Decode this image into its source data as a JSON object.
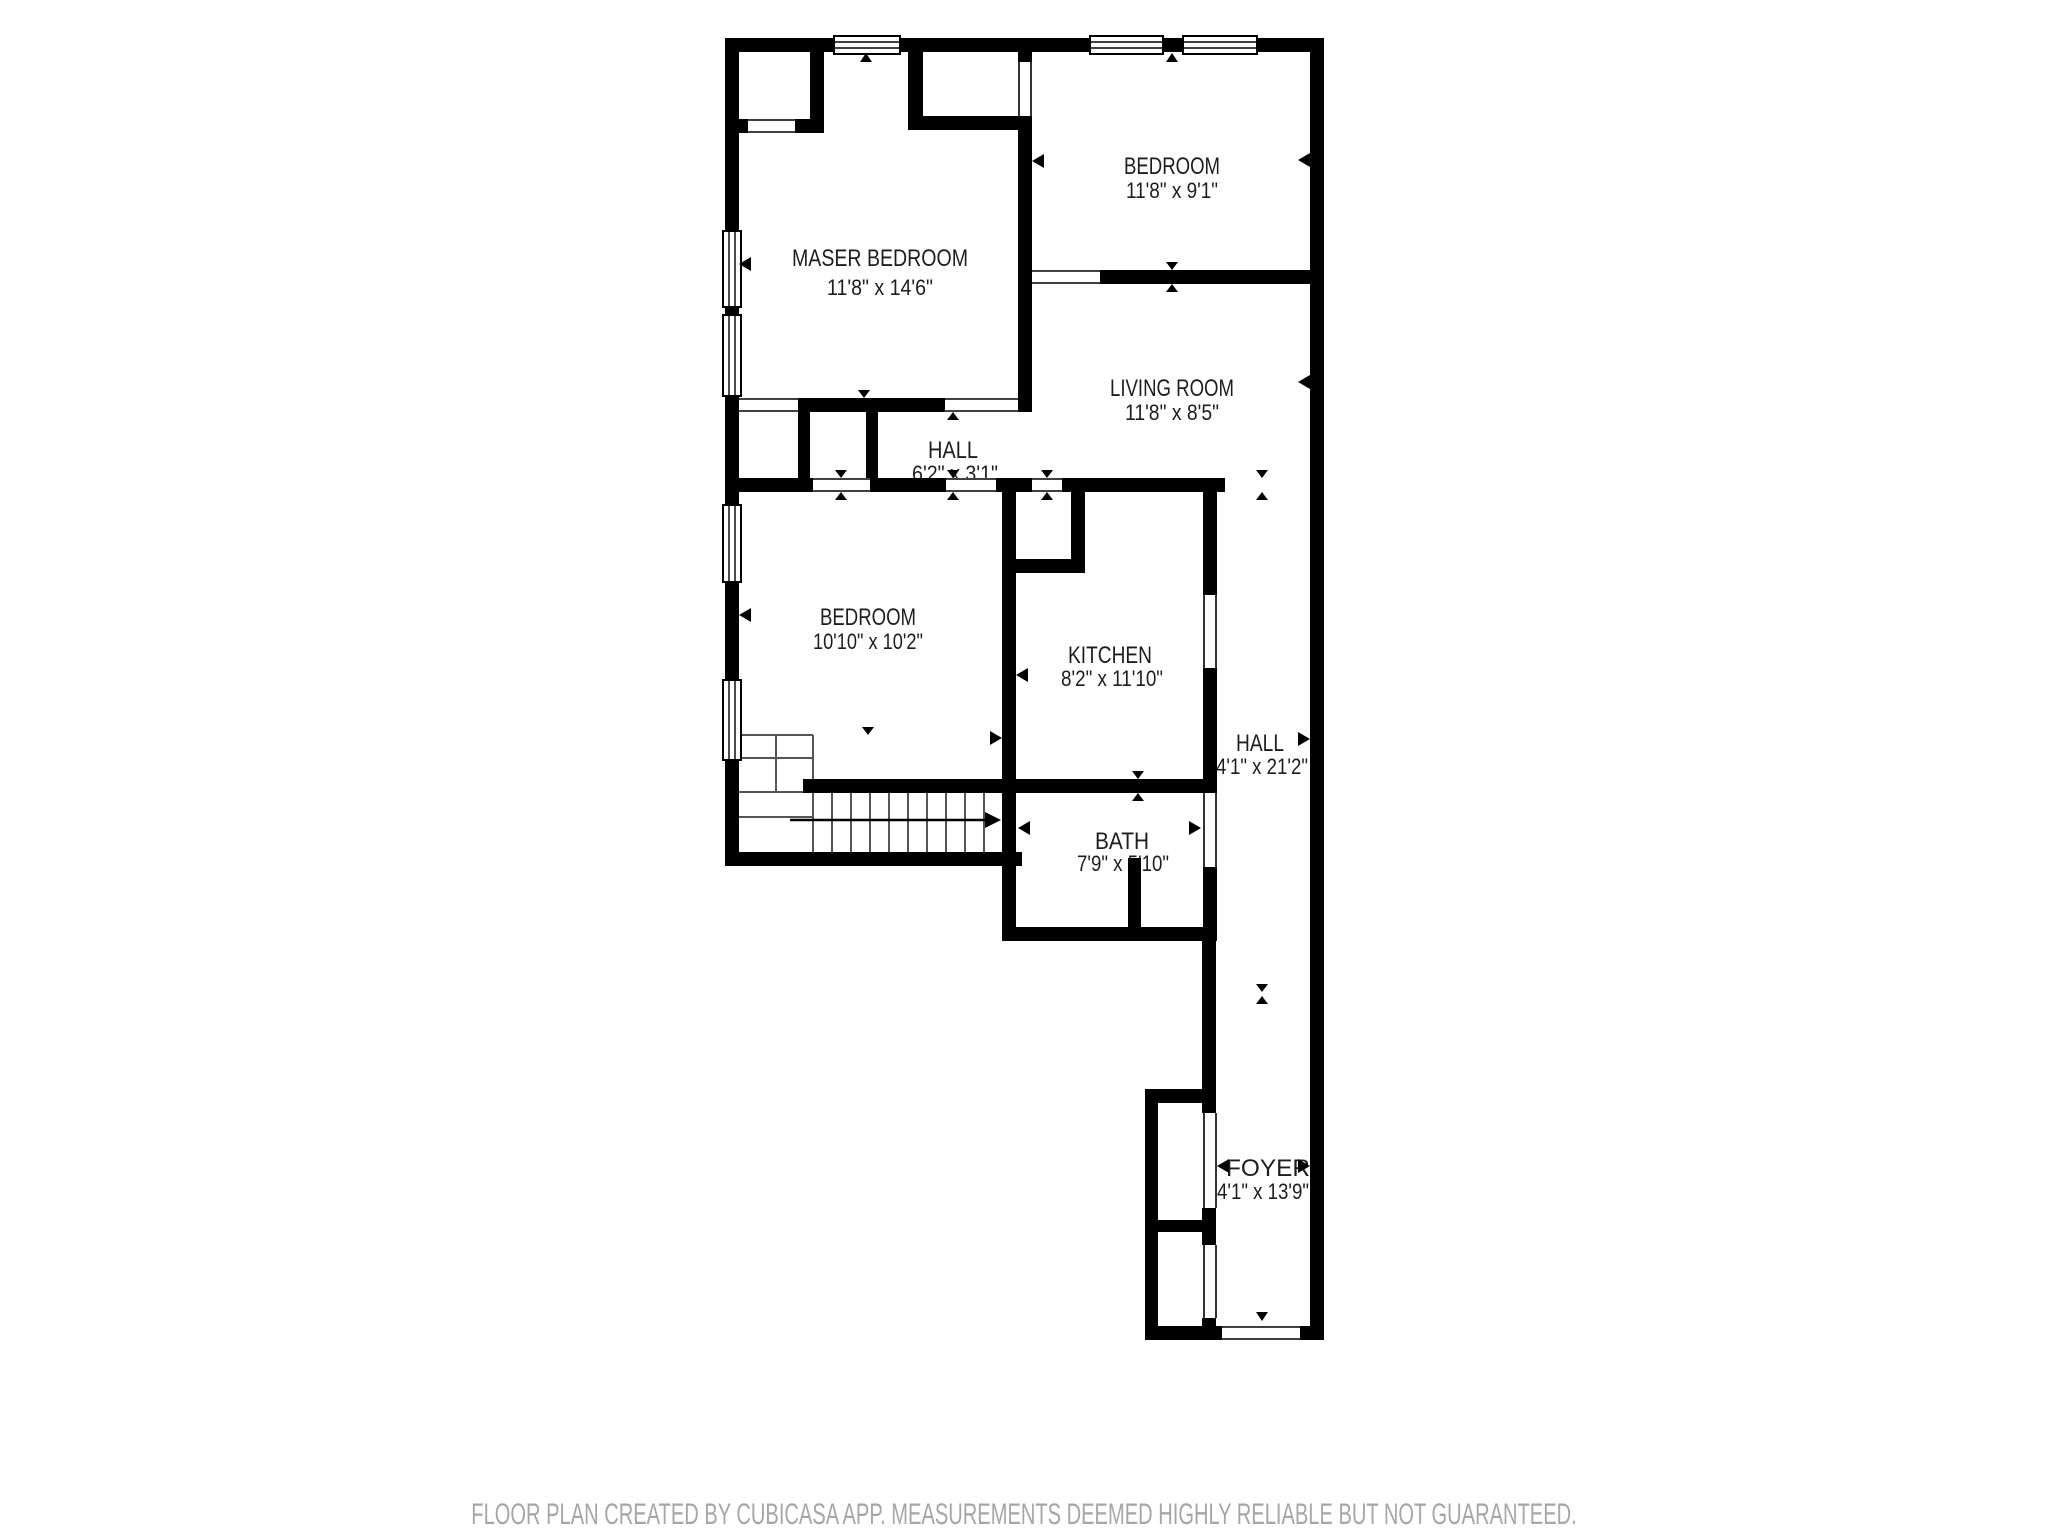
{
  "footer": {
    "disclaimer": "FLOOR PLAN CREATED BY CUBICASA APP. MEASUREMENTS DEEMED HIGHLY RELIABLE BUT NOT GUARANTEED."
  },
  "colors": {
    "wall": "#000000",
    "background": "#ffffff",
    "label": "#1d1d1d",
    "stair_line": "#555555",
    "footer_text": "#a6a6a6"
  },
  "rooms": [
    {
      "id": "master-bedroom",
      "name": "MASER BEDROOM",
      "dimensions": "11'8\" x 14'6\"",
      "label": {
        "x": 880,
        "y": 266,
        "w": 176
      },
      "dim": {
        "x": 880,
        "y": 295,
        "w": 106
      }
    },
    {
      "id": "bedroom-top",
      "name": "BEDROOM",
      "dimensions": "11'8\" x 9'1\"",
      "label": {
        "x": 1172,
        "y": 174,
        "w": 96
      },
      "dim": {
        "x": 1172,
        "y": 198,
        "w": 92
      }
    },
    {
      "id": "living-room",
      "name": "LIVING ROOM",
      "dimensions": "11'8\" x 8'5\"",
      "label": {
        "x": 1172,
        "y": 396,
        "w": 124
      },
      "dim": {
        "x": 1172,
        "y": 420,
        "w": 94
      }
    },
    {
      "id": "hall",
      "name": "HALL",
      "dimensions": "6'2\" x 3'1\"",
      "label": {
        "x": 953,
        "y": 458,
        "w": 50
      },
      "dim": {
        "x": 955,
        "y": 481,
        "w": 86
      }
    },
    {
      "id": "bedroom-left",
      "name": "BEDROOM",
      "dimensions": "10'10\" x 10'2\"",
      "label": {
        "x": 868,
        "y": 625,
        "w": 96
      },
      "dim": {
        "x": 868,
        "y": 649,
        "w": 110
      }
    },
    {
      "id": "kitchen",
      "name": "KITCHEN",
      "dimensions": "8'2\" x 11'10\"",
      "label": {
        "x": 1110,
        "y": 663,
        "w": 84
      },
      "dim": {
        "x": 1112,
        "y": 686,
        "w": 102
      }
    },
    {
      "id": "hall-corridor",
      "name": "HALL",
      "dimensions": "4'1\" x 21'2\"",
      "label": {
        "x": 1260,
        "y": 751,
        "w": 48
      },
      "dim": {
        "x": 1262,
        "y": 774,
        "w": 92
      }
    },
    {
      "id": "bath",
      "name": "BATH",
      "dimensions": "7'9\" x 5'10\"",
      "label": {
        "x": 1122,
        "y": 849,
        "w": 54
      },
      "dim": {
        "x": 1123,
        "y": 871,
        "w": 92
      }
    },
    {
      "id": "foyer",
      "name": "FOYER",
      "dimensions": "4'1\" x 13'9\"",
      "label": {
        "x": 1268,
        "y": 1176,
        "w": 84
      },
      "dim": {
        "x": 1263,
        "y": 1199,
        "w": 92
      }
    }
  ],
  "geometry": {
    "walls": [
      [
        725,
        38,
        109,
        14
      ],
      [
        900,
        38,
        190,
        14
      ],
      [
        1163,
        38,
        20,
        14
      ],
      [
        1257,
        38,
        67,
        14
      ],
      [
        1310,
        38,
        14,
        1302
      ],
      [
        725,
        38,
        14,
        193
      ],
      [
        725,
        307,
        14,
        8
      ],
      [
        725,
        396,
        14,
        109
      ],
      [
        725,
        582,
        14,
        98
      ],
      [
        725,
        760,
        14,
        106
      ],
      [
        725,
        852,
        297,
        14
      ],
      [
        1002,
        482,
        14,
        459
      ],
      [
        1002,
        927,
        214,
        14
      ],
      [
        1202,
        941,
        14,
        162
      ],
      [
        1145,
        1089,
        71,
        14
      ],
      [
        1145,
        1089,
        13,
        251
      ],
      [
        1145,
        1326,
        77,
        14
      ],
      [
        1300,
        1326,
        24,
        14
      ],
      [
        810,
        38,
        14,
        95
      ],
      [
        739,
        119,
        9,
        14
      ],
      [
        795,
        119,
        29,
        14
      ],
      [
        908,
        38,
        15,
        92
      ],
      [
        908,
        116,
        124,
        14
      ],
      [
        1018,
        52,
        14,
        10
      ],
      [
        1018,
        116,
        14,
        296
      ],
      [
        798,
        398,
        147,
        14
      ],
      [
        798,
        412,
        12,
        66
      ],
      [
        866,
        412,
        12,
        66
      ],
      [
        725,
        478,
        88,
        14
      ],
      [
        870,
        478,
        76,
        14
      ],
      [
        996,
        478,
        36,
        14
      ],
      [
        1062,
        478,
        163,
        14
      ],
      [
        1071,
        492,
        14,
        81
      ],
      [
        1016,
        559,
        69,
        14
      ],
      [
        1100,
        270,
        224,
        14
      ],
      [
        803,
        779,
        413,
        14
      ],
      [
        1203,
        492,
        14,
        103
      ],
      [
        1203,
        668,
        14,
        125
      ],
      [
        1203,
        867,
        14,
        74
      ],
      [
        1202,
        1103,
        14,
        10
      ],
      [
        1202,
        1208,
        14,
        37
      ],
      [
        1202,
        1318,
        14,
        8
      ],
      [
        1158,
        1220,
        58,
        12
      ],
      [
        1128,
        858,
        13,
        69
      ]
    ],
    "windows": [
      [
        834,
        36,
        66,
        18
      ],
      [
        1090,
        36,
        73,
        18
      ],
      [
        1183,
        36,
        74,
        18
      ],
      [
        723,
        231,
        18,
        76
      ],
      [
        723,
        315,
        18,
        81
      ],
      [
        723,
        505,
        18,
        77
      ],
      [
        723,
        680,
        18,
        80
      ]
    ],
    "doors": [
      [
        748,
        119,
        47,
        14,
        "h"
      ],
      [
        1018,
        62,
        14,
        54,
        "v"
      ],
      [
        945,
        398,
        73,
        14,
        "h"
      ],
      [
        739,
        398,
        59,
        14,
        "h"
      ],
      [
        813,
        478,
        57,
        14,
        "h"
      ],
      [
        946,
        478,
        50,
        14,
        "h"
      ],
      [
        1032,
        478,
        30,
        14,
        "h"
      ],
      [
        1032,
        270,
        68,
        14,
        "h"
      ],
      [
        1203,
        595,
        14,
        73,
        "v"
      ],
      [
        1203,
        793,
        14,
        74,
        "v"
      ],
      [
        1203,
        1113,
        14,
        95,
        "v"
      ],
      [
        1203,
        1245,
        14,
        73,
        "v"
      ],
      [
        1222,
        1326,
        78,
        14,
        "h"
      ]
    ],
    "stairs": {
      "lines": [
        [
          832,
          793,
          832,
          852
        ],
        [
          851,
          793,
          851,
          852
        ],
        [
          870,
          793,
          870,
          852
        ],
        [
          889,
          793,
          889,
          852
        ],
        [
          908,
          793,
          908,
          852
        ],
        [
          927,
          793,
          927,
          852
        ],
        [
          946,
          793,
          946,
          852
        ],
        [
          965,
          793,
          965,
          852
        ],
        [
          984,
          793,
          984,
          852
        ],
        [
          739,
          735,
          813,
          735
        ],
        [
          739,
          758,
          813,
          758
        ],
        [
          739,
          792,
          813,
          792
        ],
        [
          739,
          817,
          813,
          817
        ],
        [
          776,
          735,
          776,
          792
        ],
        [
          813,
          735,
          813,
          852
        ]
      ],
      "arrow": {
        "shaft": [
          790,
          820,
          985,
          820
        ],
        "head": [
          985,
          812,
          1001,
          820,
          985,
          828
        ]
      }
    },
    "markers": [
      [
        860,
        62,
        872,
        62,
        866,
        53
      ],
      [
        1166,
        62,
        1178,
        62,
        1172,
        53
      ],
      [
        1310,
        153,
        1310,
        167,
        1298,
        160
      ],
      [
        1310,
        375,
        1310,
        389,
        1298,
        382
      ],
      [
        1298,
        732,
        1298,
        746,
        1310,
        739
      ],
      [
        1030,
        257,
        1030,
        271,
        1018,
        264
      ],
      [
        1044,
        154,
        1044,
        168,
        1032,
        161
      ],
      [
        858,
        390,
        870,
        390,
        864,
        398
      ],
      [
        947,
        420,
        959,
        420,
        953,
        412
      ],
      [
        1166,
        262,
        1178,
        262,
        1172,
        270
      ],
      [
        1166,
        292,
        1178,
        292,
        1172,
        284
      ],
      [
        835,
        470,
        847,
        470,
        841,
        478
      ],
      [
        835,
        500,
        847,
        500,
        841,
        492
      ],
      [
        947,
        470,
        959,
        470,
        953,
        478
      ],
      [
        947,
        500,
        959,
        500,
        953,
        492
      ],
      [
        1041,
        470,
        1053,
        470,
        1047,
        478
      ],
      [
        1041,
        500,
        1053,
        500,
        1047,
        492
      ],
      [
        1256,
        470,
        1268,
        470,
        1262,
        478
      ],
      [
        1256,
        500,
        1268,
        500,
        1262,
        492
      ],
      [
        1132,
        771,
        1144,
        771,
        1138,
        779
      ],
      [
        1132,
        801,
        1144,
        801,
        1138,
        793
      ],
      [
        1028,
        668,
        1028,
        682,
        1016,
        675
      ],
      [
        1030,
        821,
        1030,
        835,
        1018,
        828
      ],
      [
        1189,
        821,
        1189,
        835,
        1201,
        828
      ],
      [
        1215,
        730,
        1215,
        744,
        1203,
        737
      ],
      [
        1256,
        984,
        1268,
        984,
        1262,
        992
      ],
      [
        1256,
        1004,
        1268,
        1004,
        1262,
        996
      ],
      [
        1229,
        1159,
        1229,
        1173,
        1217,
        1166
      ],
      [
        1298,
        1159,
        1298,
        1173,
        1310,
        1166
      ],
      [
        1256,
        1312,
        1268,
        1312,
        1262,
        1321
      ],
      [
        862,
        727,
        874,
        727,
        868,
        735
      ],
      [
        751,
        257,
        751,
        271,
        739,
        264
      ],
      [
        751,
        608,
        751,
        622,
        739,
        615
      ],
      [
        990,
        731,
        990,
        745,
        1002,
        738
      ]
    ]
  }
}
